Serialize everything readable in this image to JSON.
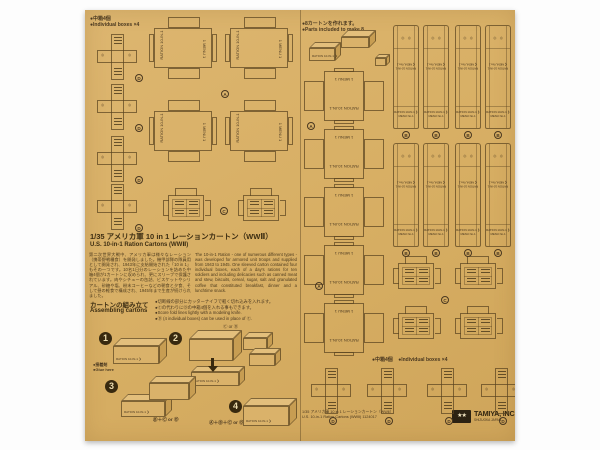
{
  "sheet": {
    "notes": {
      "boxes4_jp": "●中箱4個",
      "boxes4_en": "●Individual boxes ×4",
      "make8_jp": "●8カートンを作れます。",
      "make8_en": "●Parts included to make 8.",
      "boxes4b_jp": "●中箱4個",
      "boxes4b_en": "●Individual boxes ×4"
    },
    "title": {
      "jp": "1/35 アメリカ軍 10 in 1 レーションカートン（WWⅡ）",
      "en": "U.S. 10-in-1 Ration Cartons (WWⅡ)"
    },
    "description": {
      "jp": "第二次世界大戦中、アメリカ軍は様々なレーション（携帯野戦糧食）を開発しました。機甲部隊の隊員用として開発され、1943年に支給開始された「10 in 1」もその一つです。10名1日分のレーションを詰めた中箱4個が1カートンに収められ、更にスリーブで保護されています。肉やシチューの缶詰、ビスケットやシリアル、砂糖や塩、粉末コーヒーなどの朝食と夕食、そして昼の軽食で構成され、1945年まで生産が続けられました。",
      "en": "The 10-in-1 Ration - one of numerous different types - was developed for armored unit troops and supplied from 1943 to 1945. One sleeved carton contained four individual boxes, each of a day's rations for ten soldiers and including delicacies such as canned meat and stew, biscuits, cereal, sugar, salt and granulated coffee that constituted breakfast, dinner and a lunchtime snack."
    },
    "assembling": {
      "heading_jp": "カートンの組み立て",
      "heading_en": "Assembling cartons",
      "bullet1": "●切断線の部分にカッターナイフで軽く切れ込みを入れます。",
      "bullet2": "●Ⓒの代わりにⒹの中箱4個を入れる事もできます。",
      "bullet3": "●Score fold lines lightly with a modeling knife.",
      "bullet4": "●Ⓓ (4 individual boxes) can be used in place of Ⓒ."
    },
    "steps": {
      "n1": "1",
      "n2": "2",
      "n3": "3",
      "n4": "4",
      "glue_jp": "●接着剤",
      "glue_en": "●Glue here",
      "marker2": "Ⓒ or Ⓓ",
      "formula3": "Ⓑ＋Ⓒ or Ⓓ",
      "formula4": "Ⓐ＋Ⓑ＋Ⓒ or Ⓓ"
    },
    "templates": {
      "carton_side_label": "RATION 10-IN-1",
      "carton_menu_label": "1 MENU 1",
      "strip_dots": "◎　◎",
      "strip_label_1": "RATION 10-IN-1",
      "strip_label_2": "❮ MENU No.1",
      "strip_label_3": "RATION 10-IN-1 ❯",
      "strip_label_4": "MENU No.1",
      "mark_a": "A",
      "mark_b": "B",
      "mark_c": "C",
      "mark_d": "D"
    },
    "footer": {
      "line1": "1/35 アメリカ軍 10 in 1 レーションカートン（WWⅡ）",
      "line2": "U.S. 10-in-1 Ration Cartons (WWⅡ) 1124017",
      "brand": "TAMIYA, INC.",
      "brand_sub": "SHIZUOKA JAPAN",
      "logo_stars": "★★"
    }
  }
}
